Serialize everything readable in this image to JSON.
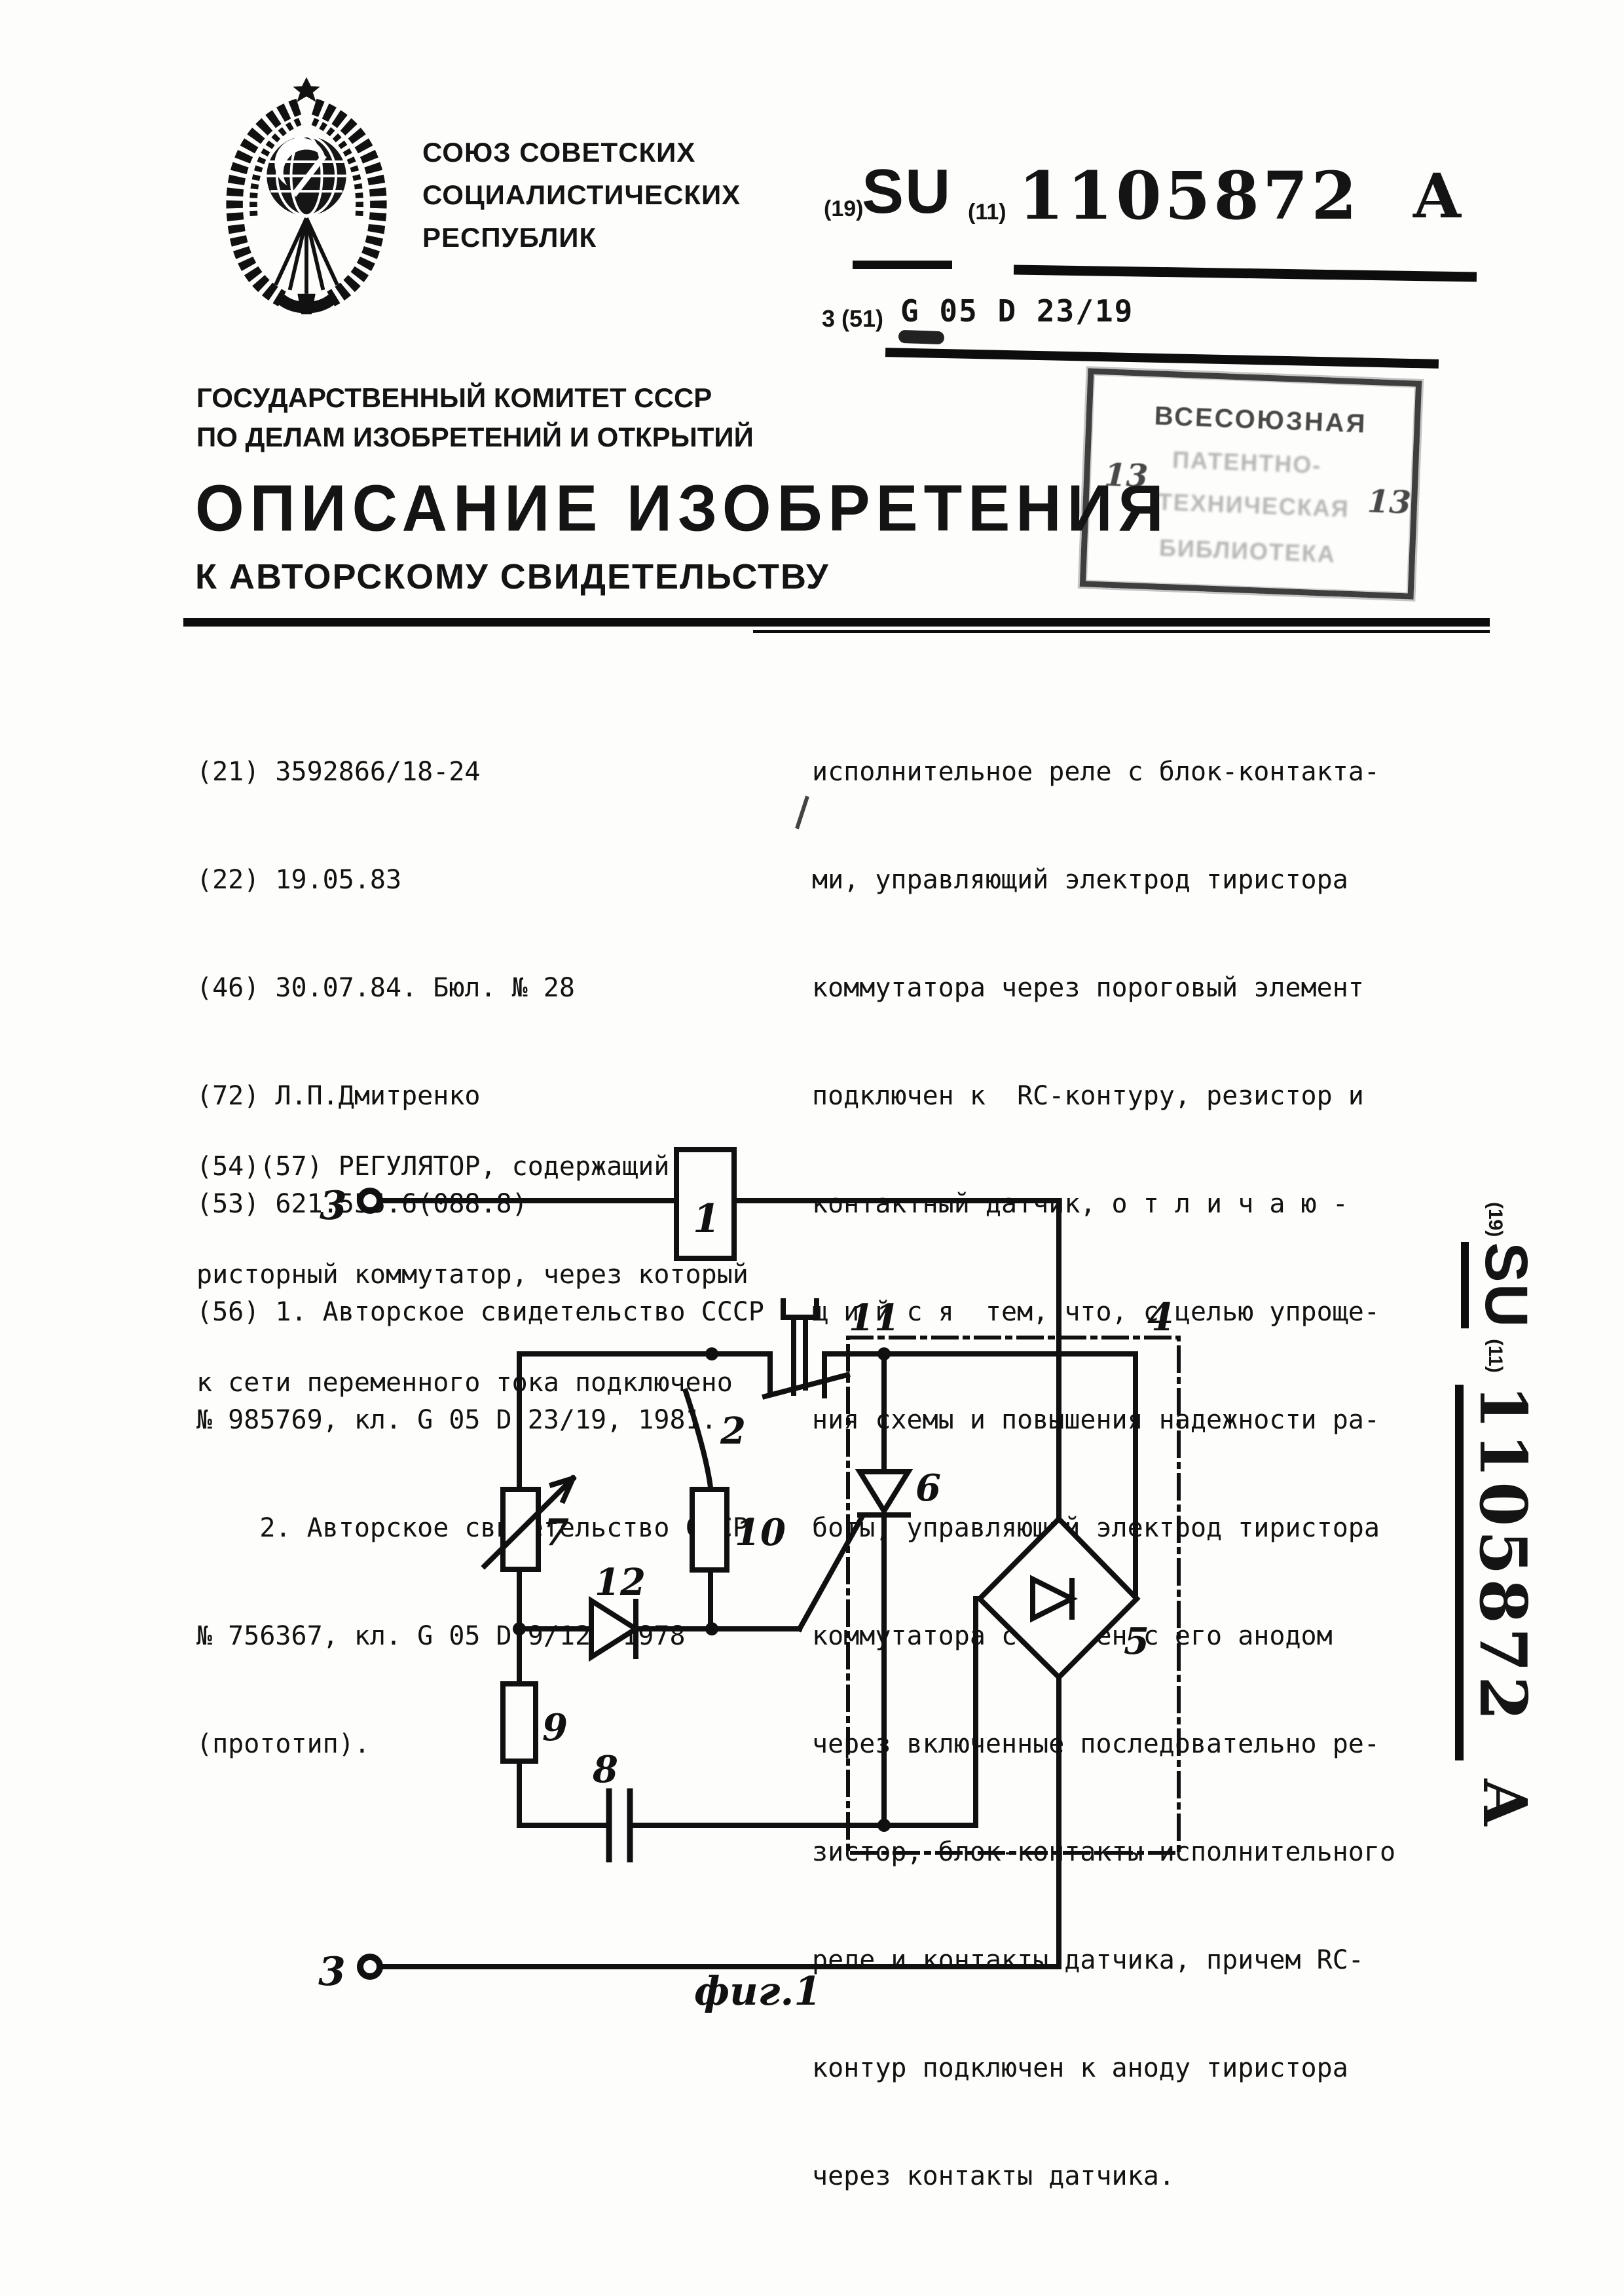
{
  "header": {
    "union_lines": [
      "СОЮЗ СОВЕТСКИХ",
      "СОЦИАЛИСТИЧЕСКИХ",
      "РЕСПУБЛИК"
    ],
    "committee_line1": "ГОСУДАРСТВЕННЫЙ КОМИТЕТ СССР",
    "committee_line2": "ПО ДЕЛАМ ИЗОБРЕТЕНИЙ И ОТКРЫТИЙ",
    "title": "ОПИСАНИЕ ИЗОБРЕТЕНИЯ",
    "subtitle": "К АВТОРСКОМУ СВИДЕТЕЛЬСТВУ",
    "code19": "(19)",
    "country": "SU",
    "code11": "(11)",
    "number": "1105872",
    "kind": "A",
    "class_index": "3 (51)",
    "class_code": "G 05 D 23/19"
  },
  "stamp": {
    "line1": "ВСЕСОЮЗНАЯ",
    "line2": "ПАТЕНТНО-",
    "line3": "ТЕХНИЧЕСКАЯ",
    "line4": "БИБЛИОТЕКА",
    "num_left": "13",
    "num_right": "13"
  },
  "left_column": {
    "ref_lines": [
      "(21) 3592866/18-24",
      "(22) 19.05.83",
      "(46) 30.07.84. Бюл. № 28",
      "(72) Л.П.Дмитренко",
      "(53) 621.555.6(088.8)",
      "(56) 1. Авторское свидетельство СССР",
      "№ 985769, кл. G 05 D 23/19, 1981.",
      "    2. Авторское свидетельство СССР",
      "№ 756367, кл. G 05 D 9/12, 1978",
      "(прототип)."
    ],
    "abstract_lines": [
      "(54)(57) РЕГУЛЯТОР, содержащий ти-",
      "ристорный коммутатор, через который",
      "к сети переменного тока подключено"
    ]
  },
  "right_column": {
    "lines": [
      "исполнительное реле с блок-контакта-",
      "ми, управляющий электрод тиристора",
      "коммутатора через пороговый элемент",
      "подключен к  RC-контуру, резистор и",
      "контактный датчик, о т л и ч а ю -",
      "щ и й с я  тем, что, с целью упроще-",
      "ния схемы и повышения надежности ра-",
      "боты, управляющий электрод тиристора",
      "коммутатора соединен с его анодом",
      "через включенные последовательно ре-",
      "зистор, блок-контакты исполнительного",
      "реле и контакты датчика, причем RC-",
      "контур подключен к аноду тиристора",
      "через контакты датчика."
    ]
  },
  "figure": {
    "caption": "фиг.1",
    "labels": {
      "l1": "1",
      "l2": "2",
      "l3_top": "3",
      "l3_bottom": "3",
      "l4": "4",
      "l5": "5",
      "l6": "6",
      "l7": "7",
      "l8": "8",
      "l9": "9",
      "l10": "10",
      "l11": "11",
      "l12": "12"
    }
  },
  "side_label": {
    "code19": "(19)",
    "country": "SU",
    "code11": "(11)",
    "number": "1105872",
    "kind": "A"
  }
}
